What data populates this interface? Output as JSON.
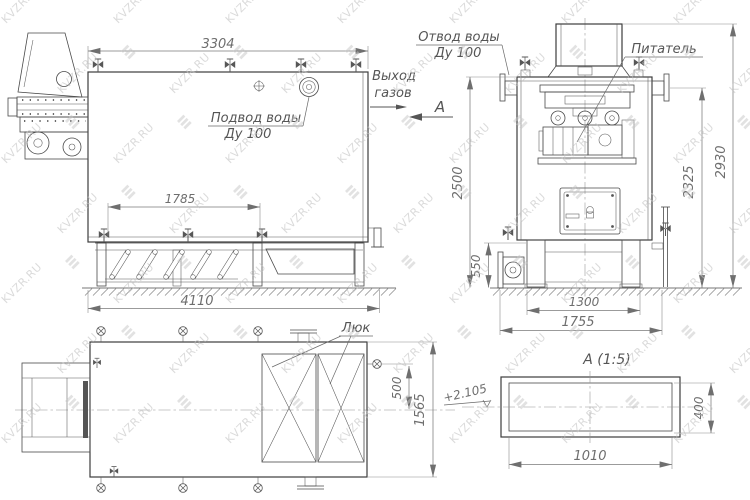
{
  "watermark": {
    "text": "KVZR.RU"
  },
  "side_view": {
    "dim_top_length": "3304",
    "dim_valve_spacing": "1785",
    "dim_total_length": "4110",
    "water_inlet_line1": "Подвод воды",
    "water_inlet_line2": "Ду 100",
    "gas_outlet_line1": "Выход",
    "gas_outlet_line2": "газов"
  },
  "front_view": {
    "water_outlet_line1": "Отвод воды",
    "water_outlet_line2": "Ду 100",
    "feeder_label": "Питатель",
    "view_label": "А",
    "dim_height_to_top": "2500",
    "dim_base_height": "550",
    "dim_height_to_flange": "2325",
    "dim_total_height": "2930",
    "dim_legs_span": "1300",
    "dim_base_width": "1755"
  },
  "plan_view": {
    "hatch_label": "Люк",
    "dim_valve_offset": "500",
    "dim_overall_width": "1565"
  },
  "section_view": {
    "title": "А (1:5)",
    "dim_width": "1010",
    "dim_height": "400",
    "elevation_mark": "+2.105"
  }
}
